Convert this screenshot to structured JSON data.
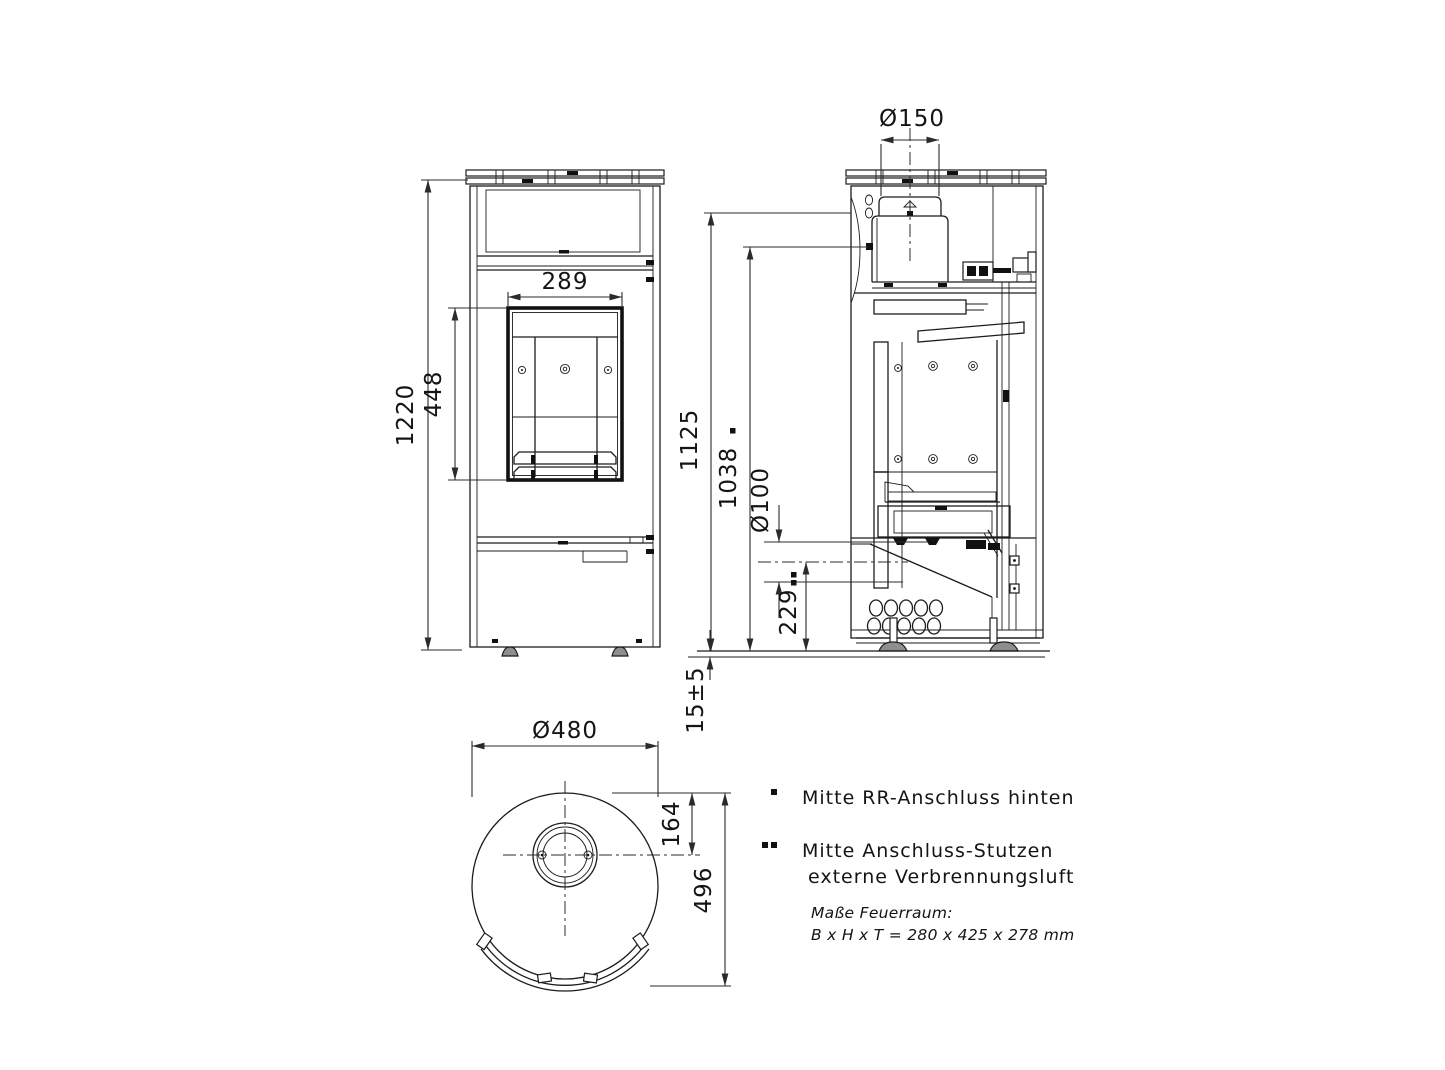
{
  "dimensions": {
    "front": {
      "total_height": "1220",
      "window_height": "448",
      "window_width": "289"
    },
    "side": {
      "flue_diameter": "Ø150",
      "top_height": "1125",
      "rear_flue_height": "1038",
      "air_inlet_diameter": "Ø100",
      "air_inlet_height": "229",
      "floor_clearance": "15±5"
    },
    "top": {
      "body_diameter": "Ø480",
      "flue_center_offset": "164",
      "depth": "496"
    }
  },
  "legend": {
    "items": [
      {
        "marker": "*",
        "text": "Mitte RR-Anschluss hinten"
      },
      {
        "marker": "**",
        "text_line1": "Mitte Anschluss-Stutzen",
        "text_line2": "externe Verbrennungsluft"
      }
    ],
    "note_line1": "Maße Feuerraum:",
    "note_line2": "B x H x T = 280 x 425 x 278 mm"
  }
}
